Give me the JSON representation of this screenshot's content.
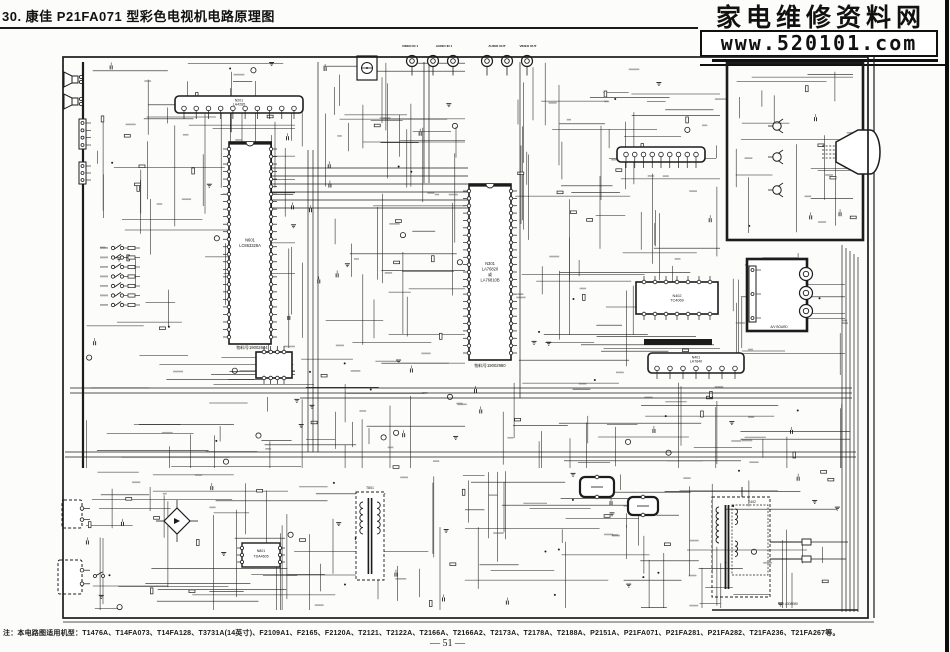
{
  "page": {
    "ink": "#1c1c1c",
    "paper": "#fcfcfb"
  },
  "header": {
    "title": "30. 康佳 P21FA071 型彩色电视机电路原理图",
    "watermark_title": "家电维修资料网",
    "watermark_url": "www.520101.com"
  },
  "footer": {
    "note": "注：本电路图适用机型：T1476A、T14FA073、T14FA128、T3731A(14英寸)、F2109A1、F2165、F2120A、T2121、T2122A、T2166A、T2166A2、T2173A、T2178A、T2188A、P2151A、P21FA071、P21FA281、P21FA282、T21FA236、T21FA267等。",
    "page_number": "— 51 —"
  },
  "schematic": {
    "frame": {
      "x": 63,
      "y": 57,
      "w": 805,
      "h": 561
    },
    "buses": [
      [
        83,
        62,
        83,
        468,
        2.2
      ],
      [
        70,
        388,
        852,
        388,
        0.7
      ],
      [
        70,
        393,
        852,
        393,
        0.7
      ],
      [
        300,
        398,
        852,
        398,
        0.7
      ],
      [
        65,
        452,
        856,
        452,
        0.7
      ],
      [
        65,
        457,
        856,
        457,
        0.7
      ],
      [
        842,
        245,
        842,
        612,
        0.7
      ],
      [
        846,
        248,
        846,
        612,
        0.7
      ],
      [
        850,
        251,
        850,
        612,
        0.7
      ],
      [
        854,
        254,
        854,
        612,
        0.7
      ],
      [
        858,
        257,
        858,
        612,
        0.7
      ],
      [
        308,
        150,
        308,
        452,
        0.7
      ],
      [
        313,
        150,
        313,
        452,
        0.7
      ],
      [
        318,
        62,
        318,
        452,
        0.7
      ],
      [
        424,
        62,
        424,
        183,
        0.7
      ],
      [
        429,
        62,
        429,
        183,
        0.7
      ],
      [
        520,
        62,
        520,
        398,
        0.7
      ],
      [
        272,
        168,
        468,
        168,
        0.7
      ],
      [
        272,
        176,
        468,
        176,
        0.7
      ],
      [
        272,
        184,
        468,
        184,
        0.7
      ],
      [
        272,
        192,
        468,
        192,
        0.7
      ],
      [
        272,
        200,
        468,
        200,
        0.7
      ],
      [
        272,
        208,
        468,
        208,
        0.7
      ],
      [
        874,
        57,
        874,
        618,
        1.2
      ],
      [
        63,
        622,
        874,
        622,
        0.7
      ],
      [
        712,
        610,
        858,
        610,
        1.4
      ]
    ],
    "components": [
      {
        "t": "ic_h",
        "x": 175,
        "y": 96,
        "w": 128,
        "h": 17,
        "pins": 10,
        "label": [
          "N201",
          "LA4285"
        ]
      },
      {
        "t": "ic_v",
        "x": 229,
        "y": 142,
        "w": 42,
        "h": 202,
        "pins": 26,
        "label": [
          "N601",
          "LC863328A"
        ]
      },
      {
        "t": "label",
        "x": 252,
        "y": 349,
        "s": 4.2,
        "text": "物料号19002644"
      },
      {
        "t": "dip_h",
        "x": 256,
        "y": 352,
        "w": 36,
        "h": 26,
        "pins": 4,
        "label": []
      },
      {
        "t": "ic_v",
        "x": 469,
        "y": 184,
        "w": 42,
        "h": 176,
        "pins": 23,
        "label": [
          "N301",
          "LA76820",
          "或",
          "LA76810B"
        ]
      },
      {
        "t": "label",
        "x": 490,
        "y": 367,
        "s": 4.2,
        "text": "物料号19002980"
      },
      {
        "t": "ic_h",
        "x": 617,
        "y": 147,
        "w": 88,
        "h": 15,
        "pins": 9,
        "label": []
      },
      {
        "t": "dip_h",
        "x": 636,
        "y": 282,
        "w": 82,
        "h": 32,
        "pins": 7,
        "label": [
          "N402",
          "TC4069"
        ]
      },
      {
        "t": "bar",
        "x": 644,
        "y": 339,
        "w": 68,
        "h": 6
      },
      {
        "t": "ic_h",
        "x": 648,
        "y": 353,
        "w": 96,
        "h": 20,
        "pins": 7,
        "label": [
          "N401",
          "LA7840"
        ]
      },
      {
        "t": "board",
        "x": 727,
        "y": 63,
        "w": 136,
        "h": 177
      },
      {
        "t": "transistor",
        "x": 777,
        "y": 126
      },
      {
        "t": "transistor",
        "x": 777,
        "y": 157
      },
      {
        "t": "transistor",
        "x": 777,
        "y": 190
      },
      {
        "t": "crt",
        "x": 836,
        "y": 128
      },
      {
        "t": "board",
        "x": 747,
        "y": 259,
        "w": 60,
        "h": 72,
        "fill": "#fff"
      },
      {
        "t": "conn_v",
        "x": 749,
        "y": 266,
        "h": 56,
        "pins": 3
      },
      {
        "t": "rca",
        "x": 806,
        "y": 274,
        "r": 6.5
      },
      {
        "t": "rca",
        "x": 806,
        "y": 293,
        "r": 6.5
      },
      {
        "t": "rca",
        "x": 806,
        "y": 311,
        "r": 6.5
      },
      {
        "t": "label",
        "x": 779,
        "y": 328,
        "s": 3.2,
        "text": "A/V BOARD"
      },
      {
        "t": "ant",
        "x": 357,
        "y": 56
      },
      {
        "t": "rca",
        "x": 412,
        "y": 61,
        "r": 5.5,
        "stem": 1
      },
      {
        "t": "rca",
        "x": 433,
        "y": 61,
        "r": 5.5,
        "stem": 1
      },
      {
        "t": "rca",
        "x": 453,
        "y": 61,
        "r": 5.5,
        "stem": 1
      },
      {
        "t": "rca",
        "x": 487,
        "y": 61,
        "r": 5.5,
        "stem": 1
      },
      {
        "t": "rca",
        "x": 507,
        "y": 61,
        "r": 5.5,
        "stem": 1
      },
      {
        "t": "rca",
        "x": 527,
        "y": 61,
        "r": 5.5,
        "stem": 1
      },
      {
        "t": "jlabel",
        "x": 410,
        "y": 47,
        "text": "VIDEO IN 1"
      },
      {
        "t": "jlabel",
        "x": 444,
        "y": 47,
        "text": "AUDIO IN 1"
      },
      {
        "t": "jlabel",
        "x": 497,
        "y": 47,
        "text": "AUDIO OUT"
      },
      {
        "t": "jlabel",
        "x": 528,
        "y": 47,
        "text": "VIDEO OUT"
      },
      {
        "t": "speaker",
        "x": 63,
        "y": 72
      },
      {
        "t": "speaker",
        "x": 63,
        "y": 94
      },
      {
        "t": "conn_v",
        "x": 79,
        "y": 119,
        "h": 30,
        "pins": 4
      },
      {
        "t": "conn_v",
        "x": 79,
        "y": 162,
        "h": 22,
        "pins": 3
      },
      {
        "t": "keypad",
        "x": 113,
        "y": 248,
        "rows": 7,
        "step": 9.5
      },
      {
        "t": "xfmr",
        "x": 356,
        "y": 492,
        "w": 28,
        "h": 88,
        "label": "T801"
      },
      {
        "t": "bridge",
        "x": 177,
        "y": 521,
        "r": 13
      },
      {
        "t": "box",
        "x": 242,
        "y": 543,
        "w": 38,
        "h": 24,
        "pins": 3,
        "label": [
          "N801",
          "TDA4605"
        ]
      },
      {
        "t": "fbt",
        "x": 712,
        "y": 497,
        "w": 58,
        "h": 100,
        "label": "T402"
      },
      {
        "t": "label",
        "x": 788,
        "y": 605,
        "s": 3.4,
        "text": "P/N 4308080",
        "i": 1
      },
      {
        "t": "dashed_box",
        "x": 62,
        "y": 500,
        "w": 20,
        "h": 28,
        "pins": 2
      },
      {
        "t": "dashed_box",
        "x": 58,
        "y": 560,
        "w": 24,
        "h": 34,
        "pins": 2
      },
      {
        "t": "switch",
        "x": 95,
        "y": 576
      },
      {
        "t": "round_box",
        "x": 580,
        "y": 477,
        "w": 34,
        "h": 20
      },
      {
        "t": "round_box",
        "x": 628,
        "y": 497,
        "w": 30,
        "h": 18
      }
    ]
  }
}
